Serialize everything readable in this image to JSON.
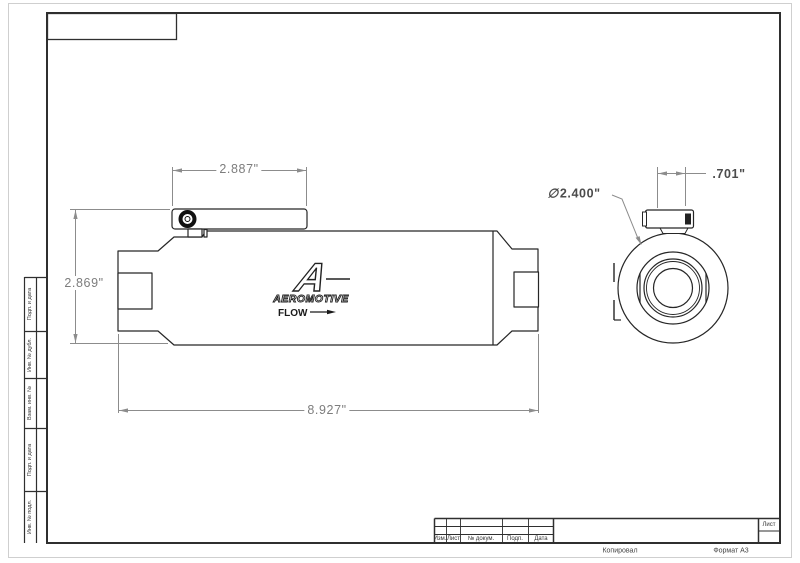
{
  "drawing": {
    "logo": {
      "letter": "A",
      "brand": "AEROMOTIVE",
      "flow": "FLOW"
    },
    "dimensions": {
      "bracket_width": "2.887\"",
      "overall_height": "2.869\"",
      "overall_length": "8.927\"",
      "end_port_width": ".701\"",
      "diameter_symbol": "∅",
      "body_diameter": "2.400\""
    }
  },
  "stamp": {
    "columns": [
      "Изм.",
      "Лист",
      "№ докум.",
      "Подп.",
      "Дата"
    ],
    "sheet_label": "Лист",
    "copied_label": "Копировал",
    "format_label": "Формат A3"
  },
  "margin_strip": {
    "items": [
      "Подп. и дата",
      "Инв. № дубл.",
      "Взам. инв. №",
      "Подп. и дата",
      "Инв. № подл."
    ]
  },
  "colors": {
    "line": "#262626",
    "frame": "#2f2f2f",
    "dim": "#8c8c8c",
    "dim_text": "#7d7d7d"
  }
}
